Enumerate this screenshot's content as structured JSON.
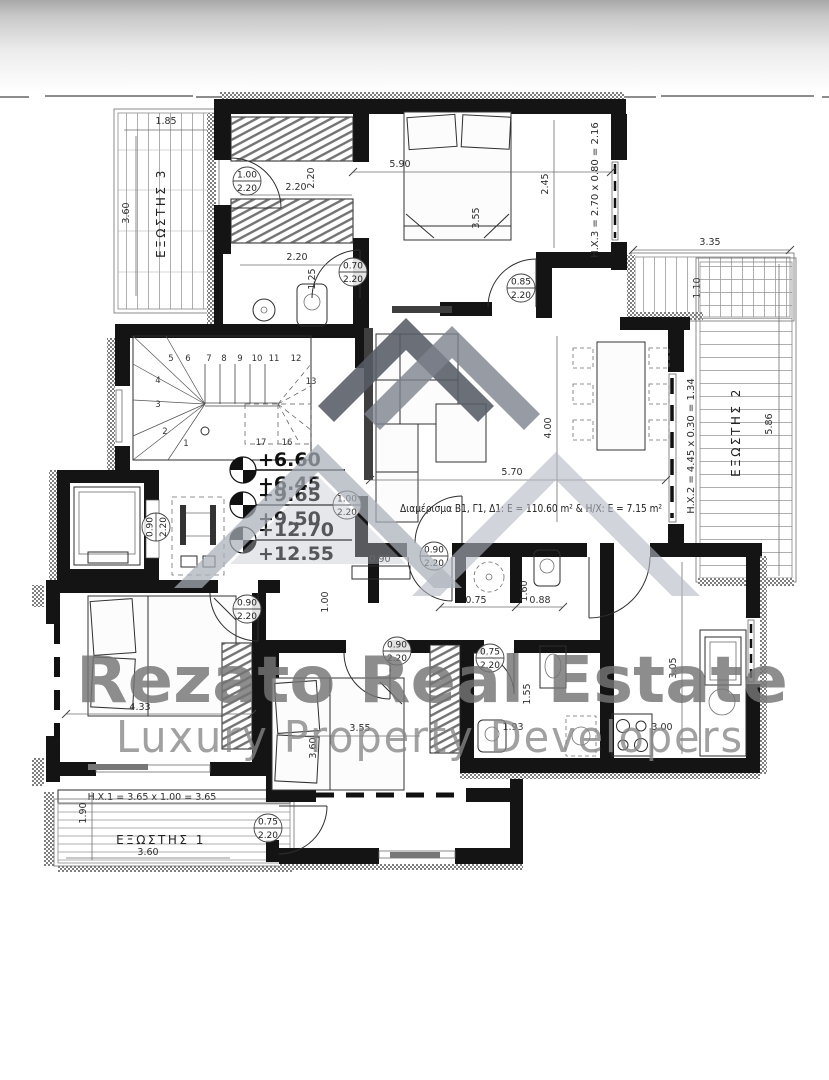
{
  "watermark": {
    "line1": "Rezato Real Estate",
    "line2": "Luxury Property Developers",
    "color1": "#757575",
    "color2": "#878787"
  },
  "logo": {
    "dark": "#575c65",
    "mid": "#7d828c",
    "light": "#a9afb9",
    "lighter": "#b3b8c1",
    "soft": "#bfc4cb"
  },
  "plan": {
    "annotation": "Διαμέρισμα Β1, Γ1, Δ1: E = 110.60 m²  &  H/X: E = 7.15 m²",
    "balconies": {
      "b1": "ΕΞΩΣΤΗΣ 1",
      "b2": "ΕΞΩΣΤΗΣ 2",
      "b3": "ΕΞΩΣΤΗΣ 3"
    },
    "hx": {
      "hx1": "H.X.1 = 3.65 x 1.00 = 3.65",
      "hx2": "H.X.2 = 4.45 x 0.30 = 1.34",
      "hx3": "H.X.3 = 2.70 x 0.80 = 2.16"
    },
    "levels": [
      {
        "upper": "+6.60",
        "lower": "+6.45"
      },
      {
        "upper": "+9.65",
        "lower": "+9.50"
      },
      {
        "upper": "+12.70",
        "lower": "+12.55"
      }
    ],
    "doors": [
      {
        "w": "1.00",
        "h": "2.20"
      },
      {
        "w": "0.70",
        "h": "2.20"
      },
      {
        "w": "0.85",
        "h": "2.20"
      },
      {
        "w": "0.90",
        "h": "2.20"
      },
      {
        "w": "1.00",
        "h": "2.20"
      },
      {
        "w": "0.90",
        "h": "2.20"
      },
      {
        "w": "0.90",
        "h": "2.20"
      },
      {
        "w": "0.90",
        "h": "2.20"
      },
      {
        "w": "0.75",
        "h": "2.20"
      },
      {
        "w": "0.75",
        "h": "2.20"
      }
    ],
    "dims": {
      "b3_w": "1.85",
      "b3_l": "3.60",
      "mb_w": "5.90",
      "mb_d": "2.45",
      "mb_l": "3.55",
      "ward_w": "2.20",
      "ward_s": "2.20",
      "bath1_w": "2.20",
      "bath1_d": "1.25",
      "btr_w": "3.35",
      "btr_d": "1.10",
      "b2_l": "5.86",
      "liv_d": "4.00",
      "liv_w": "5.70",
      "hall_cab": "0.90",
      "hall_w": "1.00",
      "wc_a": "0.75",
      "wc_b": "0.88",
      "wc_h": "1.60",
      "bath2_d": "1.55",
      "bath2_w": "1.93",
      "kit_d": "3.05",
      "kit_w": "3.00",
      "bd1_w": "4.33",
      "bd2_w": "3.55",
      "bd2_l": "3.60",
      "b1_d": "1.90",
      "b1_w": "3.60"
    },
    "stairs": {
      "numbers": [
        "1",
        "2",
        "3",
        "4",
        "5",
        "6",
        "7",
        "8",
        "9",
        "10",
        "11",
        "12",
        "13",
        "16",
        "17"
      ]
    }
  }
}
